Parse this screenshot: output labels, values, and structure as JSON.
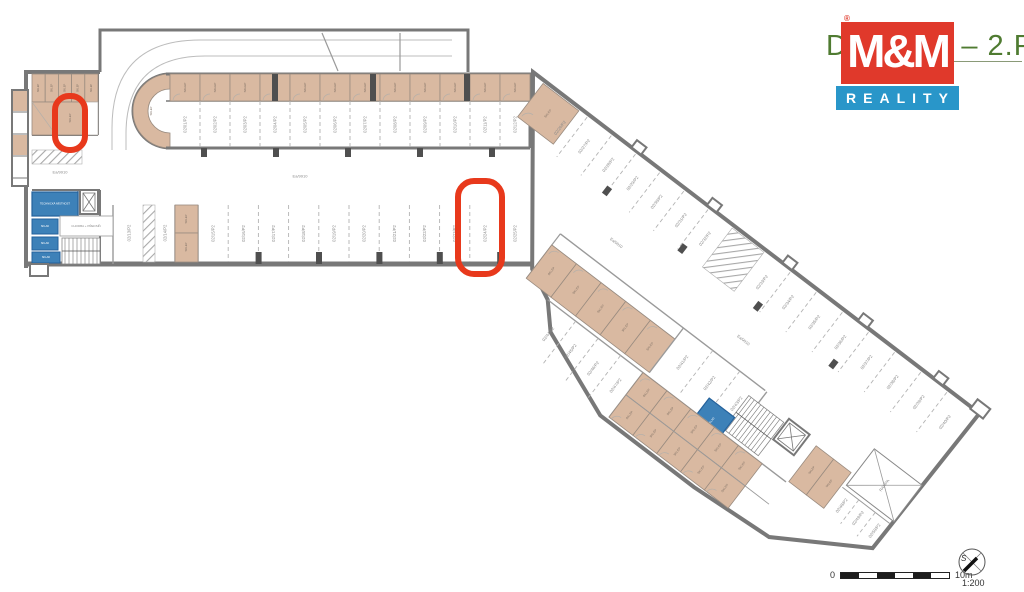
{
  "title": {
    "text": "DUKLA 2 – 2.PP"
  },
  "logo": {
    "mm": "M&M",
    "reality": "REALITY",
    "registered": "®",
    "red": "#e0392b",
    "blue": "#2996c9"
  },
  "scalebar": {
    "zero": "0",
    "max": "10m",
    "ratio": "1:200",
    "north_letter": "S"
  },
  "colors": {
    "wall": "#787878",
    "tan": "#d9b9a1",
    "tan_border": "#9a8c80",
    "blue": "#3d81b8",
    "blue_border": "#24619b",
    "pier": "#4f4f4f",
    "dash": "#b3b3b3",
    "label": "#8a8a8a",
    "highlight": "#e8391c",
    "hatch": "#a8a8a8",
    "thin": "#9a9a9a"
  },
  "plan": {
    "aisle_label": "Ea/9910",
    "rooms": {
      "cellar": "SKLEP",
      "tech_room": "TECHNICKÁ MÍSTNOST",
      "storage": "SKLAD",
      "corridor": "CHODBA + PŘEDSÍŇ",
      "ramp": "RAMPA"
    },
    "wingA_top_stalls": [
      "02/01/P2",
      "02/02/P2",
      "02/03/P2",
      "02/04/P2",
      "02/05/P2",
      "02/06/P2",
      "02/07/P2",
      "02/08/P2",
      "02/09/P2",
      "02/10/P2",
      "02/11/P2",
      "02/12/P2"
    ],
    "wingA_bottom_stalls": [
      "02/13/P2",
      "02/14/P2",
      "02/15/P2",
      "02/16/P2",
      "02/17/P2",
      "02/18/P2",
      "02/19/P2",
      "02/20/P2",
      "02/21/P2",
      "02/22/P2",
      "02/23/P2",
      "02/24/P2",
      "02/25/P2"
    ],
    "wingB_ne_stalls": [
      "02/26/P2",
      "02/27/P2",
      "02/28/P2",
      "02/29/P2",
      "02/30/P2",
      "02/31/P2",
      "02/32/P2",
      "02/33/P2",
      "02/34/P2",
      "02/35/P2",
      "02/36/P2",
      "02/37/P2",
      "02/38/P2",
      "02/39/P2",
      "02/40/P2"
    ],
    "wingB_sw_stalls": [
      "02/41/P2",
      "02/42/P2",
      "02/43/P2"
    ],
    "wingB_lower_stalls": [
      "02/44/P2",
      "02/45/P2",
      "02/46/P2",
      "02/47/P2"
    ],
    "wingB_tip_stalls": [
      "02/48/P2",
      "02/49/P2",
      "02/50/P2"
    ]
  }
}
